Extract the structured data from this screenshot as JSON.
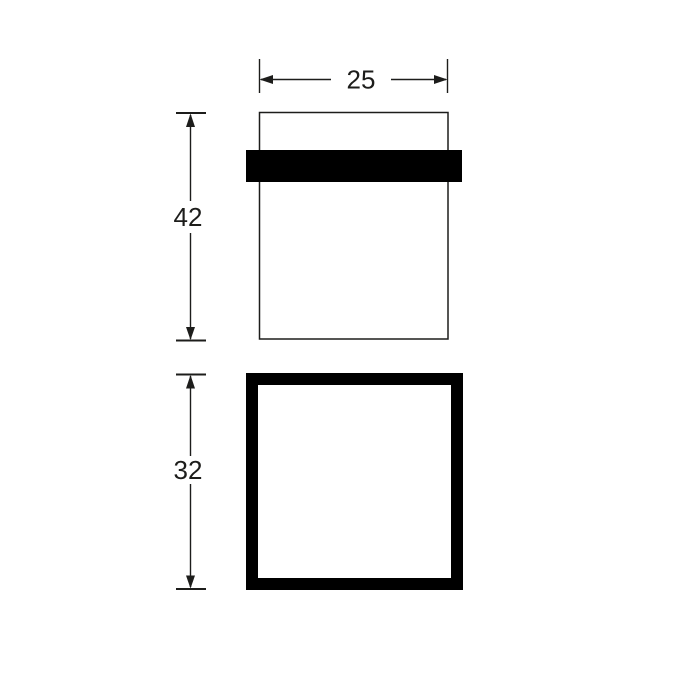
{
  "drawing": {
    "width_dimension": {
      "label": "25"
    },
    "front_height_dimension": {
      "label": "42"
    },
    "top_height_dimension": {
      "label": "32"
    },
    "colors": {
      "line": "#1d1d1b",
      "solid_fill": "#000000",
      "background": "#ffffff"
    }
  }
}
